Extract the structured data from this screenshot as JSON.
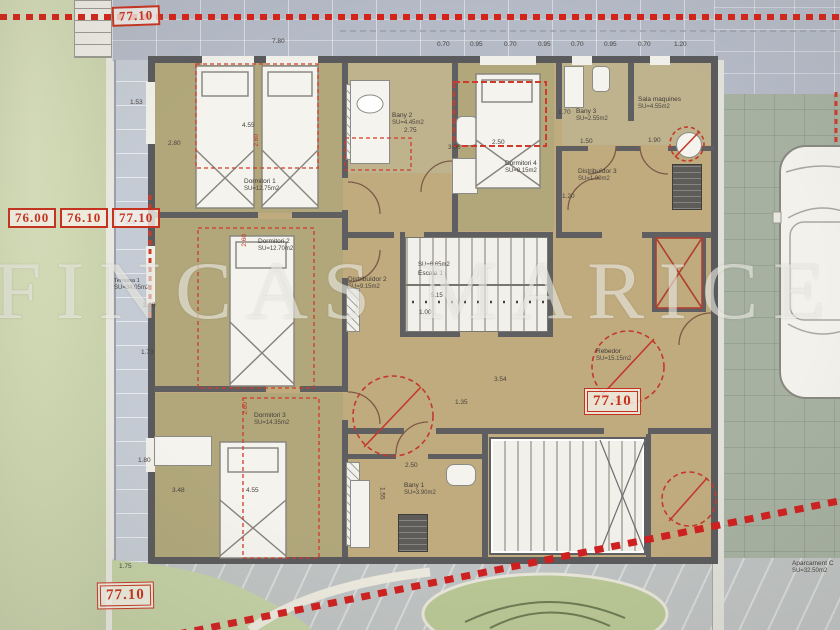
{
  "watermark": "FINCAS MARICEL",
  "markers": {
    "top": "77.10",
    "row": [
      "76.00",
      "76.10",
      "77.10"
    ],
    "interior": "77.10",
    "bottom": "77.10"
  },
  "rooms": [
    {
      "name": "Dormitori 1",
      "area": "SU=12.75m2"
    },
    {
      "name": "Dormitori 2",
      "area": "SU=12.70m2"
    },
    {
      "name": "Dormitori 3",
      "area": "SU=14.35m2"
    },
    {
      "name": "Dormitori 4",
      "area": "SU=8.15m2"
    },
    {
      "name": "Bany 1",
      "area": "SU=3.90m2"
    },
    {
      "name": "Bany 2",
      "area": "SU=4.45m2"
    },
    {
      "name": "Bany 3",
      "area": "SU=2.55m2"
    },
    {
      "name": "Sala maquines",
      "area": "SU=4.55m2"
    },
    {
      "name": "Distribuïdor 2",
      "area": "SU=9.15m2"
    },
    {
      "name": "Distribuïdor 3",
      "area": "SU=1.90m2"
    },
    {
      "name": "Escala 1",
      "area": "SU=6.65m2"
    },
    {
      "name": "Rebedor",
      "area": "SU=15.15m2"
    },
    {
      "name": "Terrassa 1",
      "area": "SU=34.05m2"
    },
    {
      "name": "Aparcament C",
      "area": "SU=32.50m2"
    }
  ],
  "dims": [
    "7.80",
    "0.70",
    "0.95",
    "0.70",
    "0.95",
    "0.70",
    "0.95",
    "0.70",
    "1.20",
    "1.53",
    "3.02",
    "2.80",
    "1.73",
    "1.80",
    "1.75",
    "4.55",
    "2.80",
    "2.60",
    "2.60",
    "2.60",
    "2.75",
    "3.06",
    "2.50",
    "1.50",
    "1.90",
    "1.70",
    "1.20",
    "5.15",
    "1.00",
    "3.54",
    "1.35",
    "2.50",
    "1.55",
    "3.48",
    "4.55"
  ],
  "colors": {
    "accent_red": "#c5321f",
    "wall": "#5a5a5c",
    "floor_tan": "#c0ab7e",
    "bedroom_floor": "#b1a77b",
    "paving_top": "#b4bac6",
    "paving_side": "#a6b1a1",
    "garden": "#cbd4ae",
    "terrace": "#c5cbd4"
  }
}
